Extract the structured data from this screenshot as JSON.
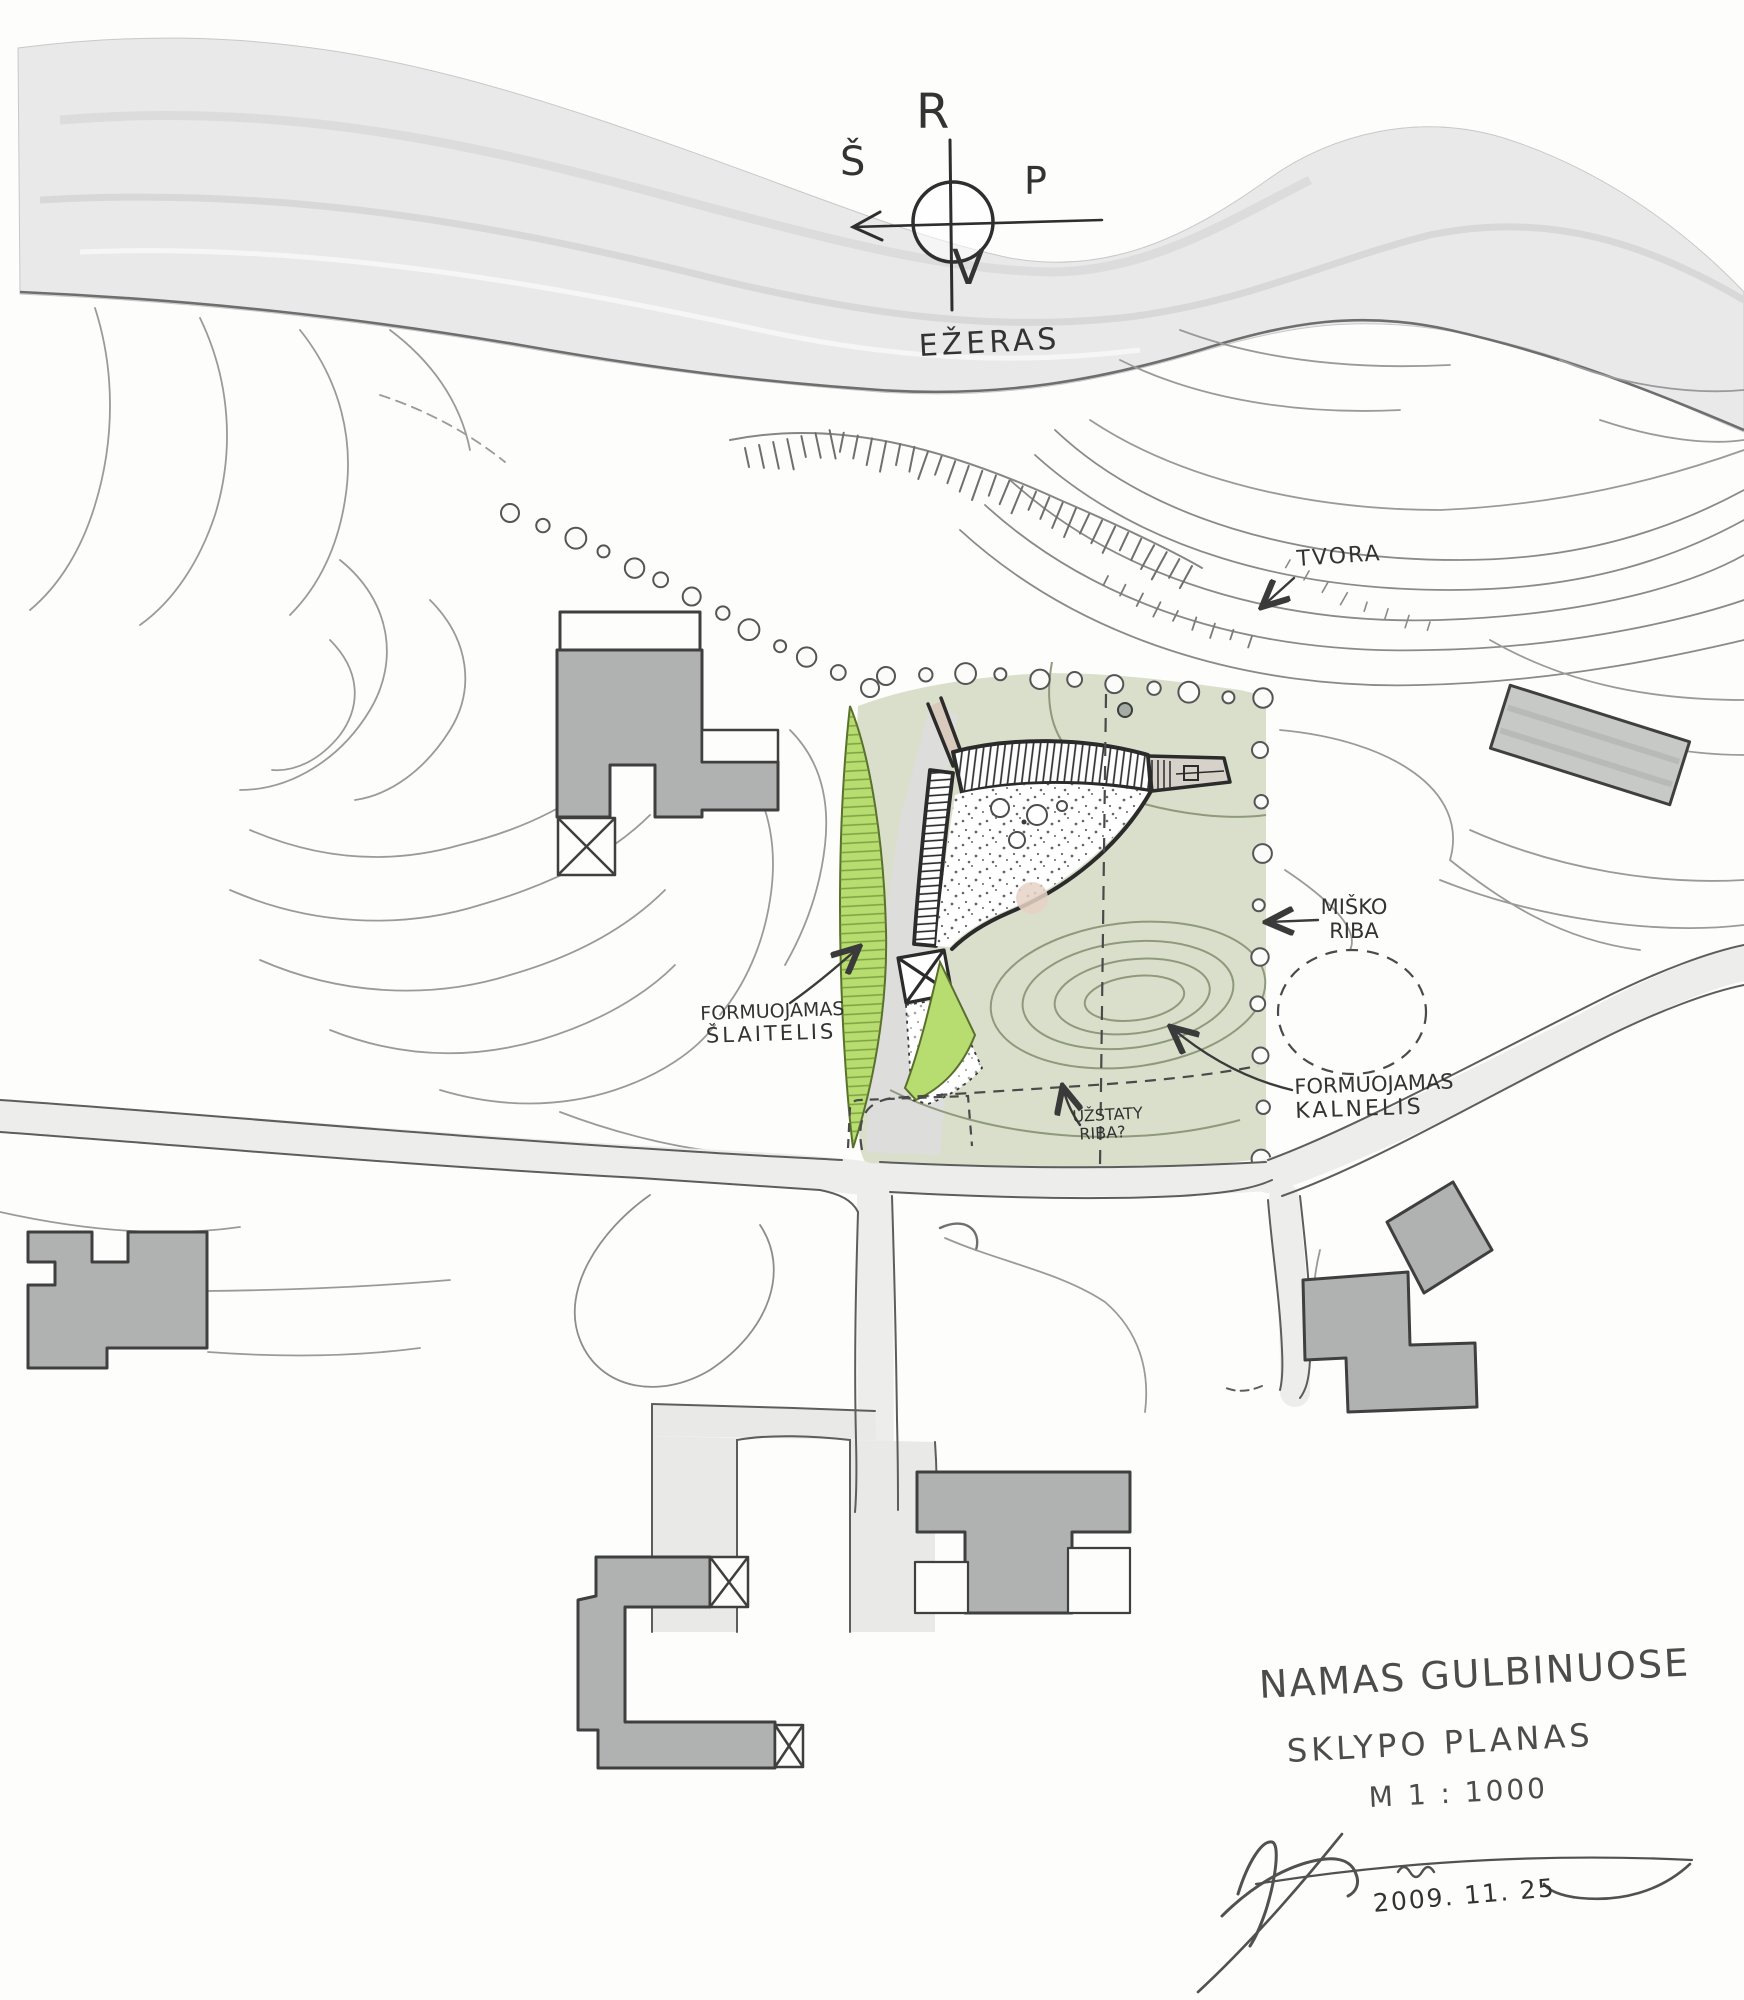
{
  "title_block": {
    "project": "NAMAS GULBINUOSE",
    "drawing": "SKLYPO PLANAS",
    "scale": "M 1 : 1000",
    "date": "2009. 11. 25"
  },
  "compass": {
    "top": "R",
    "right": "P",
    "bottom": "V",
    "left": "Š"
  },
  "labels": {
    "lake": "EŽERAS",
    "fence": "TVORA",
    "forest1": "MIŠKO",
    "forest2": "RIBA",
    "slope1": "FORMUOJAMAS",
    "slope2": "ŠLAITELIS",
    "hill1": "FORMUOJAMAS",
    "hill2": "KALNELIS",
    "limit1": "UŽSTATY",
    "limit2": "RIBA?"
  },
  "colors": {
    "lake_gray": "#e9e9e9",
    "site_green": "#dadfcb",
    "slope_green": "#b7dc6f",
    "building_gray": "#b0b2b1",
    "ink": "#3a3a3a",
    "contour_gray": "#999999"
  }
}
